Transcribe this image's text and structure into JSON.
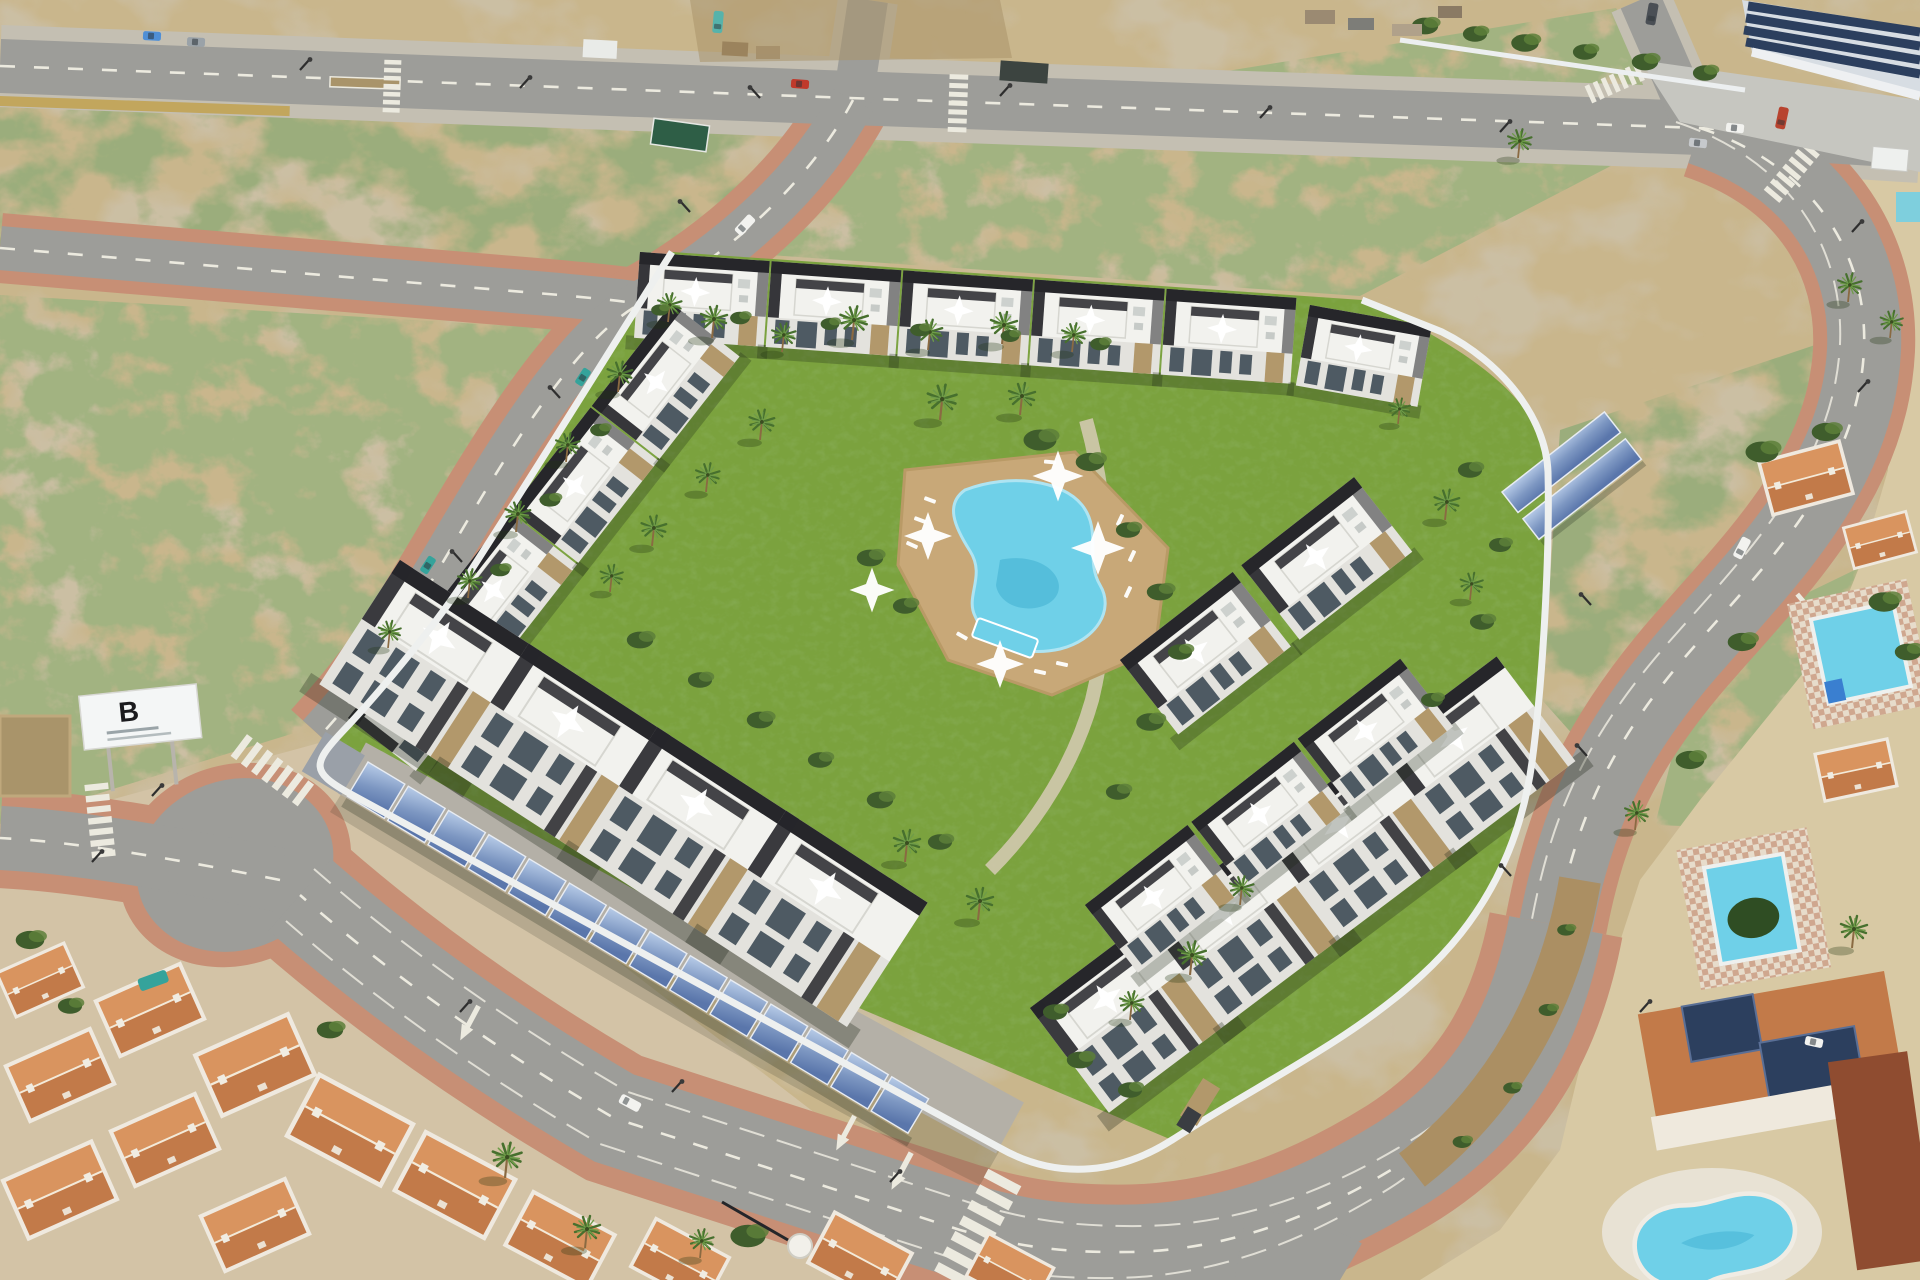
{
  "meta": {
    "title": "Aerial 3D render of a new-build residential complex with communal pool garden",
    "view": "oblique aerial, daytime",
    "domain_note": "architectural visualisation photo-composite"
  },
  "billboard": {
    "label": "B"
  },
  "colors": {
    "sand": "#c9b68c",
    "sandLight": "#d8c9a4",
    "sandDark": "#a9946a",
    "scrubGreen": "#6f814c",
    "scrubDark": "#4f6238",
    "lawn": "#7ba23e",
    "lawnDark": "#5f8a33",
    "hedge": "#3f5d2c",
    "hedgeLight": "#5d7f3a",
    "road": "#9d9d99",
    "roadLight": "#b9b7b0",
    "roadDark": "#8e8e8a",
    "marking": "#eceadf",
    "salmon": "#c78f75",
    "salmonLight": "#d8a78f",
    "grayWalk": "#c4bfb2",
    "wallWhite": "#eef0ef",
    "dark": "#26262a",
    "roofW": "#f2f2ee",
    "fac": "#e3e2dd",
    "glass": "#4e5a63",
    "stone": "#b2986b",
    "deck": "#c8a878",
    "poolWater": "#6fd0e8",
    "poolLight": "#aee4f2",
    "poolDeep": "#35a8cc",
    "panel": "#8fa8cc",
    "panelDark": "#2c3f5e",
    "terra": "#c27a49",
    "terraLight": "#d9945f",
    "terraDark": "#8f4c30",
    "cream": "#ece2cf",
    "shadow": "#1d2616",
    "palmGreen": "#6f9c49",
    "palmDark": "#47702e",
    "mustard": "#c2a14e",
    "carTeal": "#35a39b",
    "truckRed": "#b8432f",
    "shed": "#3c4440",
    "signGreen": "#2e5e46"
  },
  "scene": {
    "development": {
      "style": "white modern townhouses with black roof-terrace parapets and stone accents",
      "amenities": [
        "communal lagoon pool",
        "kids pool",
        "sun loungers",
        "white shade sails",
        "palm garden",
        "solar carport parking"
      ],
      "carport_panel_count": 14,
      "ne_solar_rows": 2
    },
    "surroundings": {
      "top": "undeveloped scrubland plots with empty roads",
      "top_right": "industrial warehouse with rooftop solar panels",
      "left": "vacant sandy plot with developer billboard",
      "bottom_left": "existing neighbourhood with terracotta gable roofs",
      "right": "villas with private pools (two rectangular, one kidney-shaped) and rooftop solar"
    },
    "pools": [
      "communal-lagoon-pool",
      "kids-pool",
      "villa-pool-upper",
      "villa-pool-rect",
      "villa-pool-kidney"
    ],
    "vehicles": [
      {
        "name": "blue-car",
        "color": "#4f8fd6"
      },
      {
        "name": "grey-car",
        "color": "#9aa2a8"
      },
      {
        "name": "red-car",
        "color": "#c0392b"
      },
      {
        "name": "teal-car-1",
        "color": "#35a39b"
      },
      {
        "name": "teal-car-2",
        "color": "#35a39b"
      },
      {
        "name": "white-van-west-road",
        "color": "#f2f2ef"
      },
      {
        "name": "white-car-top",
        "color": "#f2f2ef"
      },
      {
        "name": "silver-car-top",
        "color": "#c6c9cc"
      },
      {
        "name": "red-truck-industrial",
        "color": "#b8432f"
      },
      {
        "name": "dark-truck-top",
        "color": "#4a4f55"
      },
      {
        "name": "teal-bus-top",
        "color": "#56b3ab"
      },
      {
        "name": "white-van-east-road",
        "color": "#f2f2ef"
      },
      {
        "name": "white-van-south-road",
        "color": "#f2f2ef"
      },
      {
        "name": "white-car-villa",
        "color": "#f2f2ef"
      }
    ]
  }
}
